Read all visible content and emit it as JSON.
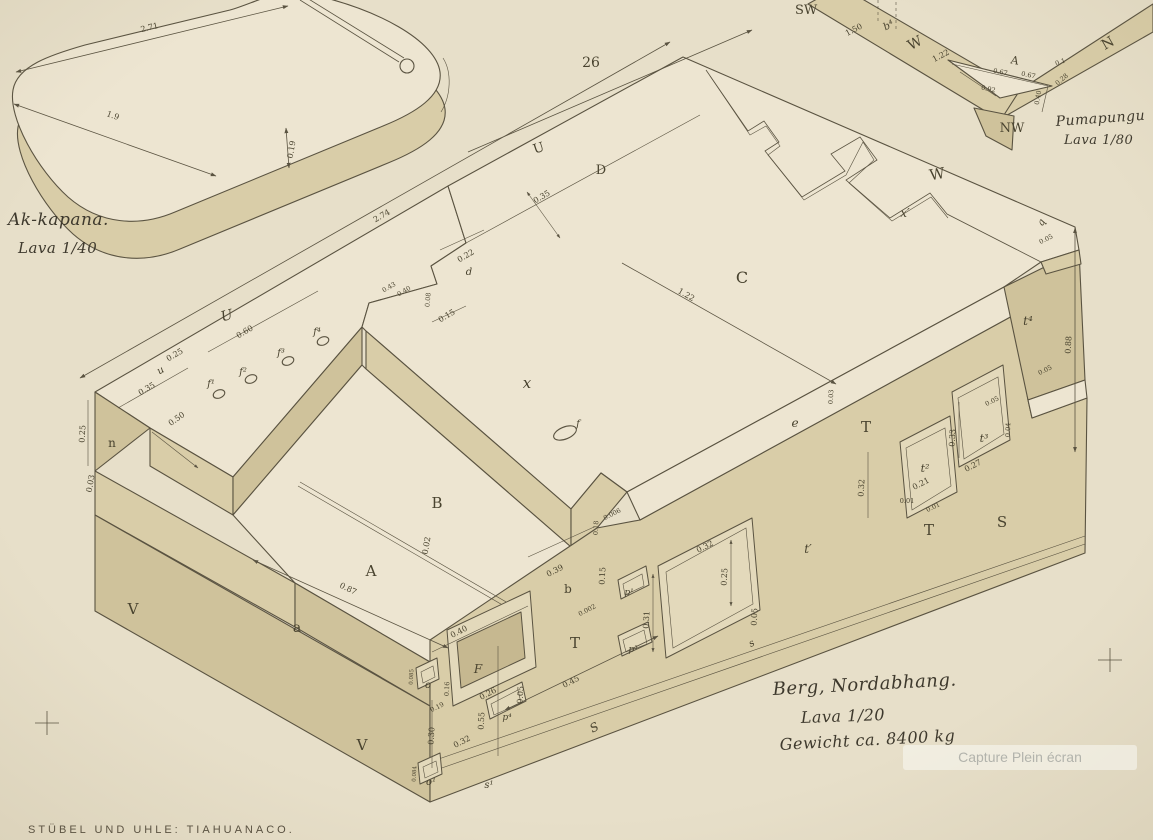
{
  "plate": {
    "number": "26",
    "footer": "STÜBEL UND UHLE: TIAHUANACO."
  },
  "overlay": {
    "label": "Capture Plein écran"
  },
  "slab": {
    "title": "Ak-kapana.",
    "scale": "Lava 1/40",
    "d_length": "2.71",
    "d_width": "1.9",
    "d_thick": "0.19"
  },
  "frag": {
    "title": "Pumapungu",
    "scale": "Lava 1/80",
    "sw": "SW",
    "nw": "NW",
    "n": "N",
    "w": "W",
    "a": "A",
    "b4": "b⁴",
    "d150": "1.50",
    "d122": "1.22",
    "d67a": "0.67",
    "d67b": "0.67",
    "d92": "0.92",
    "d40": "0.40",
    "d28": "0.28",
    "d01": "0.1"
  },
  "block": {
    "caption": {
      "line1": "Berg, Nordabhang.",
      "line2": "Lava 1/20",
      "line3": "Gewicht ca. 8400 kg"
    },
    "letters": {
      "u_edge": "U",
      "d_top": "D",
      "w_top": "W",
      "x_prime": "x′",
      "c_top": "C",
      "q": "q",
      "u_script": "U",
      "u_small": "u",
      "x_top": "x",
      "n": "n",
      "b_mid": "B",
      "a_mid": "A",
      "a_small": "a",
      "b_small": "b",
      "v_upper": "V",
      "v_lower": "V",
      "t_left": "T",
      "t_mid": "T",
      "t_low": "T",
      "s_right": "S",
      "s_edge": "S",
      "e": "e",
      "d_small": "d",
      "f": "f",
      "f1": "f¹",
      "f2": "f²",
      "f3": "f³",
      "f4": "f⁴",
      "t_p": "t′",
      "t_2": "t²",
      "t_3": "t³",
      "t_4": "t⁴",
      "f_niche": "F",
      "o": "o",
      "o1": "o¹",
      "p1": "p¹",
      "p3": "p³",
      "p4": "p⁴",
      "s_small": "s",
      "s1_small": "s¹"
    },
    "dims": {
      "d274": "2.74",
      "d035": "0.35",
      "d122": "1.22",
      "d088": "0.88",
      "d060": "0.60",
      "d025a": "0.25",
      "d035b": "0.35",
      "d050": "0.50",
      "d025n": "0.25",
      "d003n": "0.03",
      "d043": "0.43",
      "d040n": "0.40",
      "d008": "0.08",
      "d015n": "0.15",
      "d022": "0.22",
      "d002": "0.02",
      "d087": "0.87",
      "d039": "0.39",
      "d015b": "0.15",
      "d0002": "0.002",
      "d018": "0.18",
      "d0006": "0.006",
      "d045": "0.45",
      "d040f": "0.40",
      "d026": "0.26",
      "d016": "0.16",
      "d019": "0.19",
      "d005f": "0.05",
      "d055": "0.55",
      "d032f": "0.32",
      "d030": "0.30",
      "d0085": "0.085",
      "d0084": "0.084",
      "d031": "0.31",
      "d025t": "0.25",
      "d032t": "0.32",
      "d005s": "0.05",
      "d032r": "0.32",
      "d021": "0.21",
      "d001a": "0.01",
      "d001b": "0.01",
      "d033": "0.33",
      "d027": "0.27",
      "d004": "0.04",
      "d005a": "0.05",
      "d005b": "0.05",
      "d003e": "0.03",
      "d005q": "0.05"
    }
  }
}
